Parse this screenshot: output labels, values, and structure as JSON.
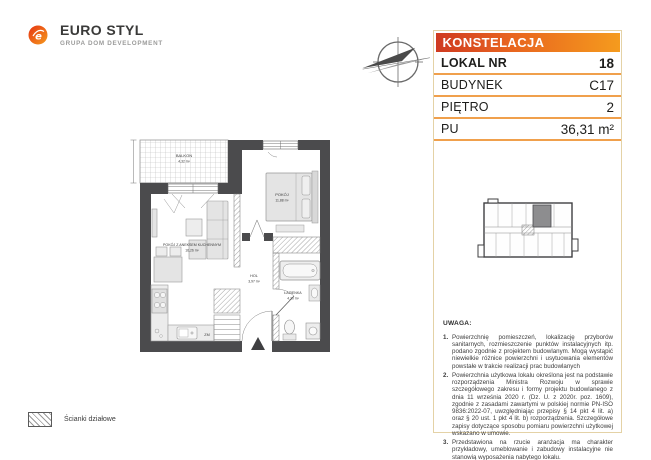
{
  "brand": {
    "name": "EURO STYL",
    "tagline": "GRUPA DOM DEVELOPMENT"
  },
  "project_panel": {
    "project_name": "KONSTELACJA",
    "rows": [
      {
        "label": "LOKAL NR",
        "value": "18"
      },
      {
        "label": "BUDYNEK",
        "value": "C17"
      },
      {
        "label": "PIĘTRO",
        "value": "2"
      },
      {
        "label": "PU",
        "value": "36,31 m²"
      }
    ],
    "accent_gradient_left": "#cf3a21",
    "accent_gradient_right": "#f59b1e",
    "border_color": "#e4d2a6",
    "separator_color": "#f0a04c"
  },
  "floorplan": {
    "rooms": [
      {
        "name": "BALKON",
        "area": "4,32 m²"
      },
      {
        "name": "POKÓJ",
        "area": "11,88 m²"
      },
      {
        "name": "POKÓJ Z ANEKSEM KUCHENNYM",
        "area": "16,26 m²"
      },
      {
        "name": "HOL",
        "area": "3,97 m²"
      },
      {
        "name": "ŁAZIENKA",
        "area": "4,20 m²"
      }
    ],
    "appliance_labels": {
      "dishwasher": "ZM"
    },
    "wall_color": "#4b4b4d"
  },
  "keyplan": {
    "highlight_color": "#8d8d8f"
  },
  "notes": {
    "heading": "UWAGA:",
    "items": [
      "Powierzchnię pomieszczeń, lokalizację przyborów sanitarnych, rozmieszczenie punktów instalacyjnych itp. podano zgodnie z projektem budowlanym. Mogą wystąpić niewielkie różnice powierzchni i usytuowania elementów powstałe w trakcie realizacji prac budowlanych",
      "Powierzchnia użytkowa lokalu określona jest na podstawie rozporządzenia Ministra Rozwoju w sprawie szczegółowego zakresu i formy projektu budowlanego z dnia 11 września 2020 r. (Dz. U. z 2020r. poz. 1609), zgodnie z zasadami zawartymi w polskiej normie PN-ISO 9836:2022-07, uwzględniając przepisy § 14 pkt 4 lit. a) oraz § 20 ust. 1 pkt 4 lit. b) rozporządzenia. Szczegółowe zapisy dotyczące sposobu pomiaru powierzchni użytkowej wskazano w umowie.",
      "Przedstawiona na rzucie aranżacja ma charakter przykładowy, umeblowanie i zabudowy instalacyjne nie stanowią wyposażenia nabytego lokalu."
    ]
  },
  "legend": {
    "partition_walls_label": "Ścianki działowe"
  }
}
